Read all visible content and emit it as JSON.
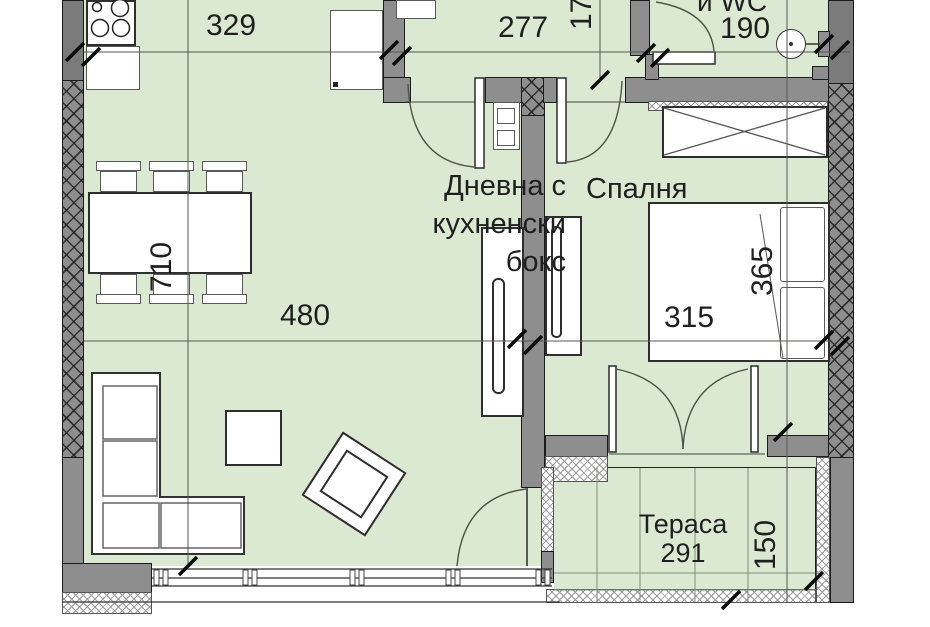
{
  "document": {
    "type": "apartment-floor-plan"
  },
  "rooms": {
    "living": {
      "label_line1": "Дневна с",
      "label_line2": "кухненски",
      "label_line3": "бокс"
    },
    "bedroom": {
      "label": "Спалня"
    },
    "terrace": {
      "label": "Тераса",
      "width_dim": "291"
    },
    "bathroom": {
      "label_partial": "и WC"
    }
  },
  "dimensions": {
    "kitchen_width": "329",
    "hall_width": "277",
    "bathroom_width": "190",
    "hall_depth": "170",
    "dining_length": "710",
    "living_width": "480",
    "bed_width": "315",
    "bedroom_depth": "365",
    "terrace_depth": "150"
  },
  "colors": {
    "floor_green": "#dbe9d3",
    "wall_gray": "#8e8e8e",
    "wall_dark": "#7b7b7b",
    "outline": "#1b1b1b",
    "dim_line": "#55584f",
    "door_arc": "#4c5348"
  }
}
